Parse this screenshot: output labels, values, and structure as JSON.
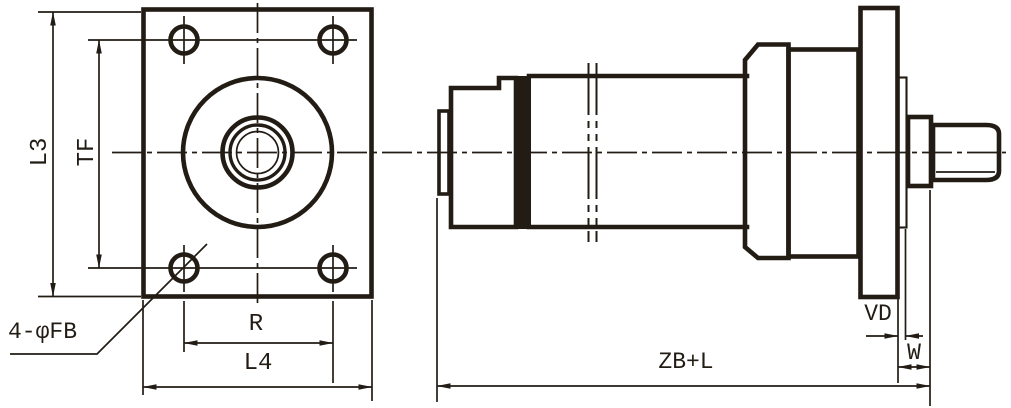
{
  "drawing": {
    "kind": "engineering-drawing",
    "colors": {
      "ink": "#221c15",
      "background": "#ffffff"
    },
    "front_view": {
      "dim_left_outer": "L3",
      "dim_left_inner": "TF",
      "dim_bolt_spacing": "R",
      "dim_bottom_outer": "L4",
      "hole_callout": "4-φFB"
    },
    "side_view": {
      "dim_overall": "ZB+L",
      "dim_pilot": "VD",
      "dim_rod_shoulder": "W"
    }
  }
}
